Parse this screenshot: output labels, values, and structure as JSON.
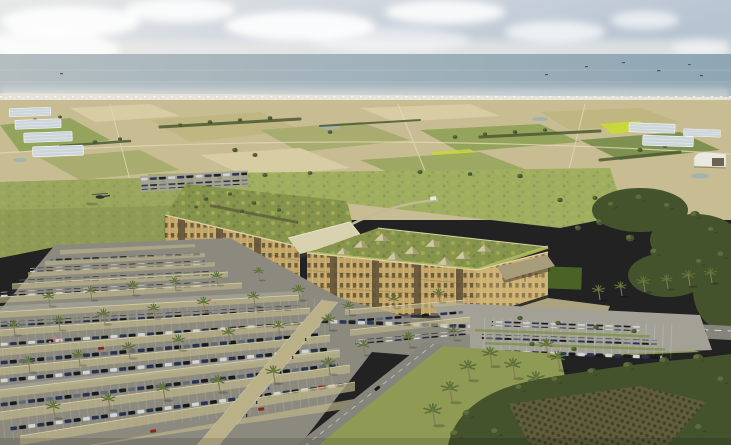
{
  "scene": {
    "type": "architectural-aerial-rendering",
    "setting": "coastal agricultural plain viewed from the air",
    "elements": {
      "sky": "hazy pale sky with cumulus clouds",
      "sea": "grey-blue sea on the horizon with small ships",
      "coastal_city": "white low-rise city strip along the shore",
      "farmland": "patchwork of tan and green fields with greenhouses, hedgerows, ponds and a white hangar",
      "campus": "two long green-roofed buildings with golden louvered facades joined by a light entry canopy",
      "skylights": "pyramid glass skylights on the front building roof",
      "helicopter": "small helicopter over the meadow west of the campus",
      "shaded_parking": "large parking lot with translucent tan canopies, rows of cars, palm trees and a diagonal pedestrian walkway",
      "open_parking": "open-air parking rows beside the access road",
      "access_road": "grey access road with white markings, planted medians and a shuttle van",
      "forest": "dense evergreen woodland and orchard in the right foreground",
      "palm_grove": "lawn strip with tall palms between the parking lot and the woodland"
    },
    "counts": {
      "buildings": 2,
      "skylight_pyramids": 9,
      "canopy_rows": 15,
      "helicopters": 1
    }
  },
  "palette": {
    "sky_left": "#e8e9e9",
    "sky_right": "#b7c4d2",
    "cloud": "#ffffff",
    "haze": "#f2f0ea",
    "sea_left": "#b4bec1",
    "sea_right": "#8fa6b4",
    "ship": "#3a4450",
    "coast": "#dcd6c8",
    "city_dot": "#f7f5ef",
    "farm_base": "#c7bc92",
    "field_tan": "#d8cca4",
    "field_tan2": "#bfb682",
    "field_green": "#94a45c",
    "field_green2": "#7f9150",
    "field_olive": "#a9ac6f",
    "field_bright": "#c6d83a",
    "hedge": "#4c5a32",
    "tree_dark": "#46542e",
    "tree_mid": "#5f7040",
    "lawn": "#a0ae60",
    "meadow": "#8f9b55",
    "pond": "#9fb4b0",
    "gh_glass": "#ccd5da",
    "shed_white": "#eae8e1",
    "facade": "#c3a667",
    "facade_light": "#cdb273",
    "facade_dark": "#645538",
    "window": "#473c28",
    "slat": "#e2c98f",
    "parapet": "#dcd3a8",
    "roof_green": "#87944b",
    "roof_moss": "#b3bd5f",
    "roof_teal": "#5e7a55",
    "canopy_link": "#d9d2b0",
    "skylight_lit": "#cfc79f",
    "skylight_shade": "#a59c72",
    "apron": "#b3ab85",
    "walkway": "#bab189",
    "asphalt": "#8c8a7e",
    "asphalt_light": "#a3a196",
    "road": "#85857b",
    "stall_line": "#ffffff",
    "canopy": "#c0b78a",
    "canopy_hi": "#d8cfa4",
    "car_navy": "#273352",
    "car_black": "#17191e",
    "car_grey": "#636b75",
    "car_white": "#d2d5d8",
    "car_red": "#8e2420",
    "van_orange": "#d7792c",
    "palm_trunk": "#8a7a5e",
    "palm_frond": "#5d7039",
    "palm_core": "#6b7c40",
    "forest": "#44532c",
    "forest_hi": "#5a6b38",
    "orchard_soil": "#665c3e",
    "orchard_tree": "#36441f",
    "shadow": "#4e4a34",
    "people": "#2e2e2e",
    "village": "#cdbd90"
  }
}
